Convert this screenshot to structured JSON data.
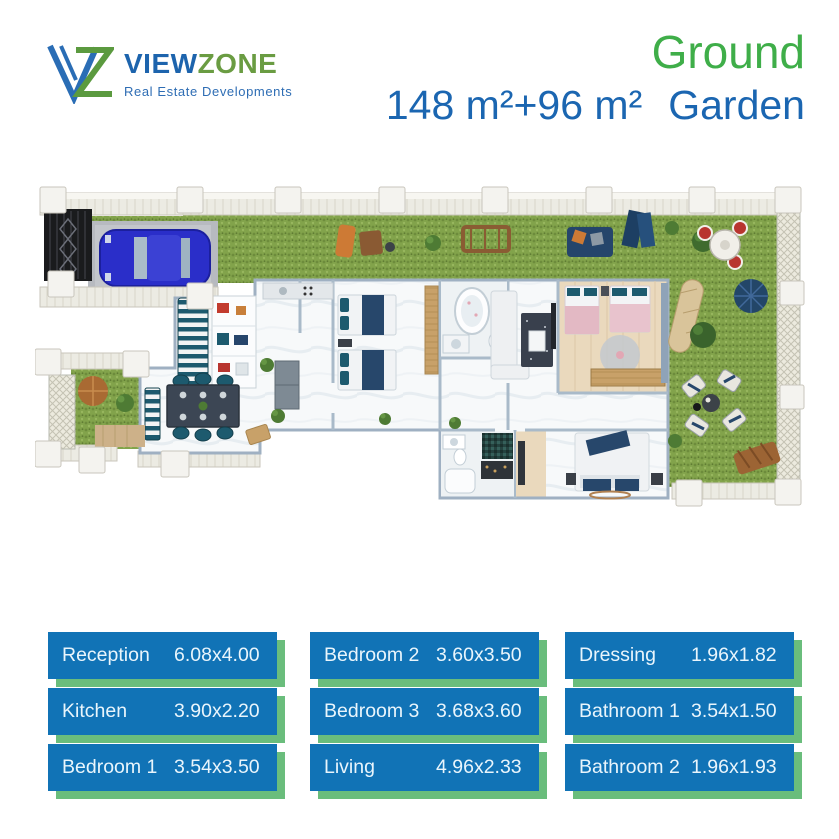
{
  "brand": {
    "name_primary": "VIEW",
    "name_secondary": "ZONE",
    "tagline": "Real Estate Developments"
  },
  "header": {
    "floor_label": "Ground",
    "area_label": "148 m²+96 m²",
    "garden_label": "Garden"
  },
  "colors": {
    "brand_blue": "#1b66b1",
    "brand_green": "#3fae49",
    "card_blue": "#1173b6",
    "card_shadow_green": "#6abd7c",
    "grass_green": "#82a34b",
    "car_blue": "#2a2ec9",
    "sofa_teal": "#1d5a6e"
  },
  "plan": {
    "icons": [
      "entrance-gate-icon",
      "car-icon",
      "garden-bench-icon",
      "lounge-chair-icon",
      "round-table-icon",
      "umbrella-icon",
      "hammock-icon",
      "dining-table-icon",
      "bed-icon",
      "bathtub-icon",
      "sofa-icon",
      "shower-icon",
      "wardrobe-icon"
    ]
  },
  "rooms": {
    "columns": [
      {
        "items": [
          {
            "name": "Reception",
            "size": "6.08x4.00"
          },
          {
            "name": "Kitchen",
            "size": "3.90x2.20"
          },
          {
            "name": "Bedroom 1",
            "size": "3.54x3.50"
          }
        ]
      },
      {
        "items": [
          {
            "name": "Bedroom 2",
            "size": "3.60x3.50"
          },
          {
            "name": "Bedroom 3",
            "size": "3.68x3.60"
          },
          {
            "name": "Living",
            "size": "4.96x2.33"
          }
        ]
      },
      {
        "items": [
          {
            "name": "Dressing",
            "size": "1.96x1.82"
          },
          {
            "name": "Bathroom 1",
            "size": "3.54x1.50"
          },
          {
            "name": "Bathroom 2",
            "size": "1.96x1.93"
          }
        ]
      }
    ]
  }
}
